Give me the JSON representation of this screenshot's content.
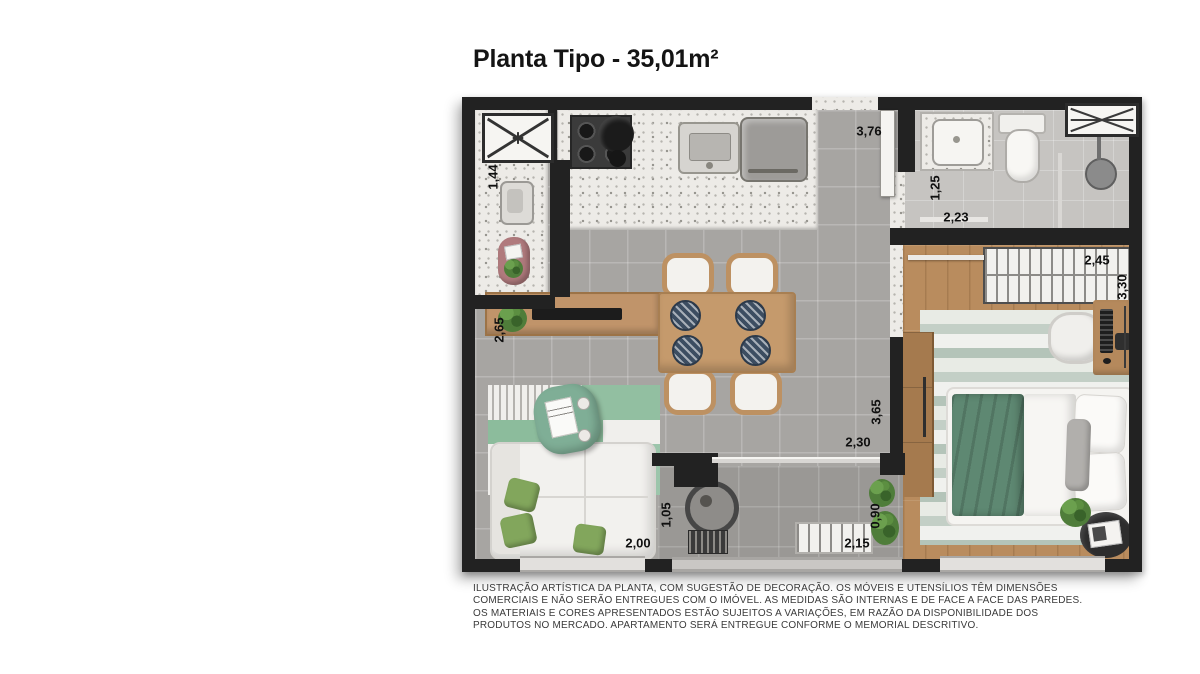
{
  "header": {
    "title": "Planta Tipo - 35,01m²"
  },
  "floor_plan": {
    "dimensions": {
      "laundry_counter": "1,44",
      "entry_hall": "3,76",
      "bathroom_width": "1,25",
      "bathroom_length": "2,23",
      "closet_width": "2,45",
      "bedroom_length": "3,30",
      "living_width": "2,65",
      "living_length": "3,65",
      "balcony_door": "2,30",
      "sofa_depth": "1,05",
      "balcony_depth": "0,90",
      "sofa_width": "2,00",
      "balcony_width": "2,15"
    },
    "rooms": [
      "kitchen-laundry",
      "living-dining",
      "entry-hall",
      "bathroom",
      "bedroom",
      "balcony"
    ],
    "colors": {
      "walls": "#222222",
      "main_floor": "#a7a5a2",
      "bathroom_floor": "#c6c4c1",
      "bedroom_wood_floor": "#b98c5e",
      "counter_granite": "#edebe7",
      "furniture_wood": "#c59a6c",
      "accent_green": "#82a65c",
      "bed_green": "#5e8872",
      "rug_green": "#92bfa1",
      "plate_navy": "#3c4d61"
    }
  },
  "footer": {
    "disclaimer": "ILUSTRAÇÃO ARTÍSTICA DA PLANTA, COM SUGESTÃO DE DECORAÇÃO. OS MÓVEIS E UTENSÍLIOS TÊM DIMENSÕES COMERCIAIS E NÃO SERÃO ENTREGUES COM O IMÓVEL. AS MEDIDAS SÃO INTERNAS E DE FACE A FACE DAS PAREDES. OS MATERIAIS E CORES APRESENTADOS ESTÃO SUJEITOS A VARIAÇÕES, EM RAZÃO DA DISPONIBILIDADE DOS PRODUTOS NO MERCADO. APARTAMENTO SERÁ ENTREGUE CONFORME O MEMORIAL DESCRITIVO."
  }
}
